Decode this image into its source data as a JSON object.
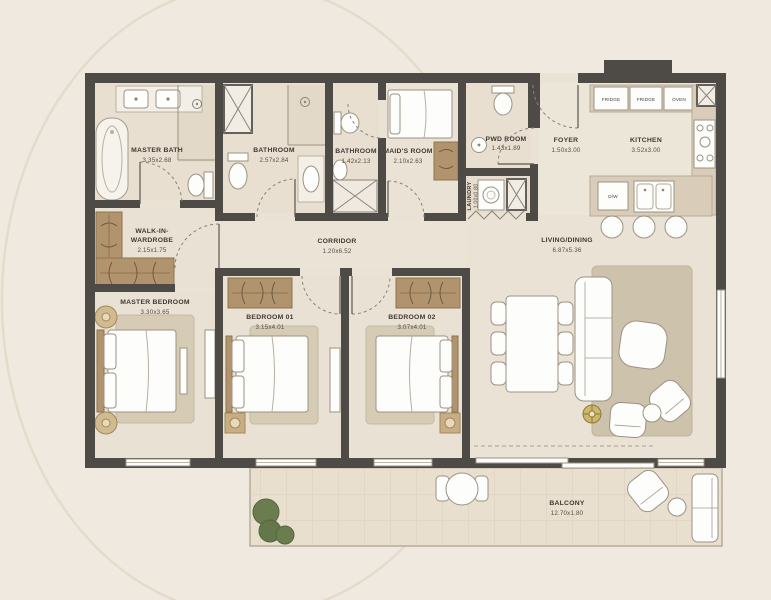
{
  "plan_title": "Apartment Floor Plan",
  "palette": {
    "background": "#f0e9e0",
    "walls": "#4e4a45",
    "floor": "#eae3d5",
    "counter_wood": "#d9cdb9",
    "closet_wood": "#b1946e",
    "rug": "#cdc2ab",
    "balcony_floor": "#e9dfcf",
    "plant_green": "#6b7d4e",
    "accent_gold": "#c2a254"
  },
  "rooms": {
    "master_bath": {
      "name": "MASTER BATH",
      "dims": "3.35x2.68"
    },
    "bathroom_a": {
      "name": "BATHROOM",
      "dims": "2.57x2.84"
    },
    "bathroom_b": {
      "name": "BATHROOM",
      "dims": "1.42x2.13"
    },
    "maids_room": {
      "name": "MAID'S ROOM",
      "dims": "2.10x2.63"
    },
    "pwd_room": {
      "name": "PWD ROOM",
      "dims": "1.43x1.89"
    },
    "laundry": {
      "name": "LAUNDRY",
      "dims": "1.00x0.80"
    },
    "foyer": {
      "name": "FOYER",
      "dims": "1.50x3.00"
    },
    "kitchen": {
      "name": "KITCHEN",
      "dims": "3.52x3.00"
    },
    "walk_in": {
      "line1": "WALK-IN-",
      "line2": "WARDROBE",
      "dims": "2.15x1.75"
    },
    "corridor": {
      "name": "CORRIDOR",
      "dims": "1.20x6.52"
    },
    "living_dining": {
      "name": "LIVING/DINING",
      "dims": "6.87x5.36"
    },
    "master_bedroom": {
      "name": "MASTER BEDROOM",
      "dims": "3.30x3.65"
    },
    "bedroom_01": {
      "name": "BEDROOM 01",
      "dims": "3.15x4.01"
    },
    "bedroom_02": {
      "name": "BEDROOM 02",
      "dims": "3.07x4.01"
    },
    "balcony": {
      "name": "BALCONY",
      "dims": "12.70x1.80"
    }
  },
  "appliances": {
    "fridge_1": "FRIDGE",
    "fridge_2": "FRIDGE",
    "oven": "OVEN",
    "dishwasher": "D/W"
  }
}
